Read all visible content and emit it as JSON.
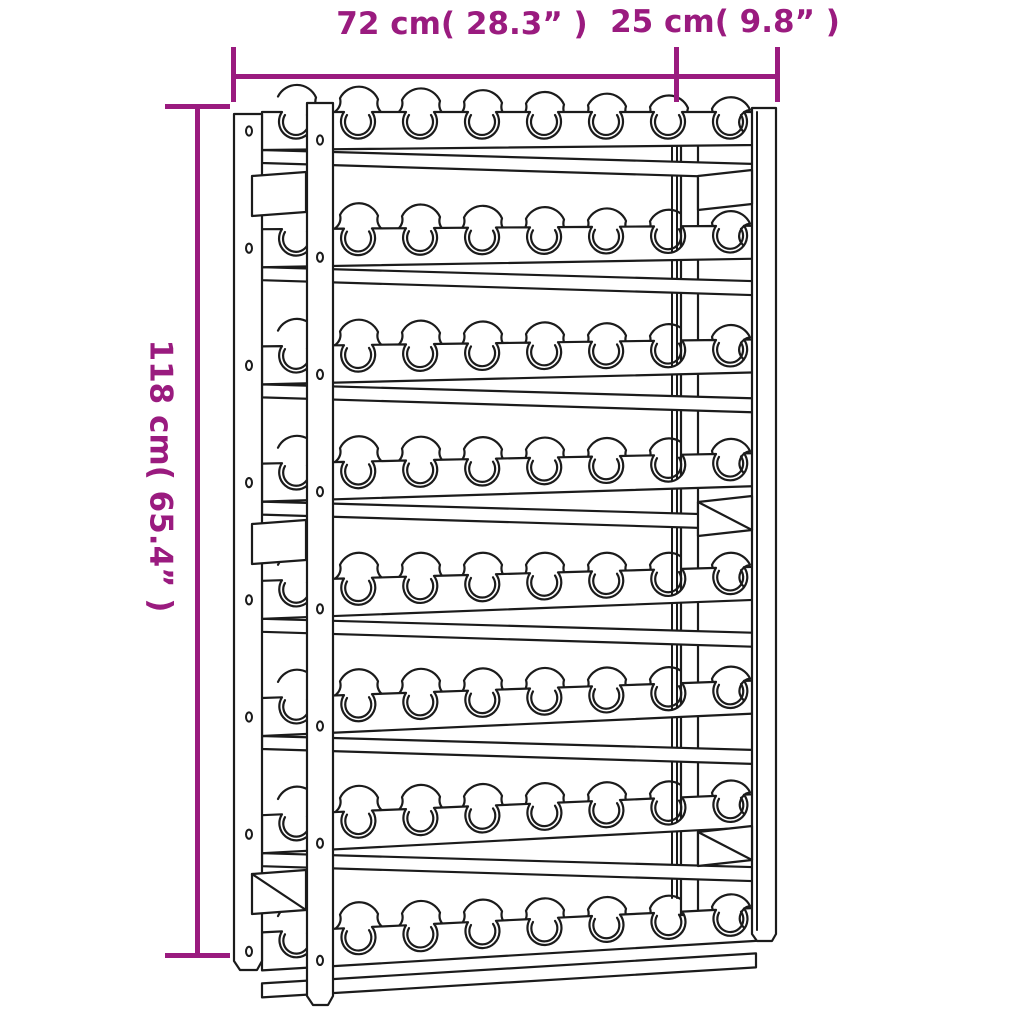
{
  "page": {
    "background_color": "#ffffff"
  },
  "dimensions": {
    "accent_color": "#9A1B7F",
    "width_label": "72 cm( 28.3” )",
    "depth_label": "25 cm( 9.8” )",
    "height_label": "118 cm( 65.4” )"
  },
  "drawing": {
    "subject": "wooden wine rack line drawing",
    "outline_color": "#1b1b1b",
    "rows": 8,
    "bottle_slots_per_row": 8,
    "screw_holes_per_leg": 8
  }
}
